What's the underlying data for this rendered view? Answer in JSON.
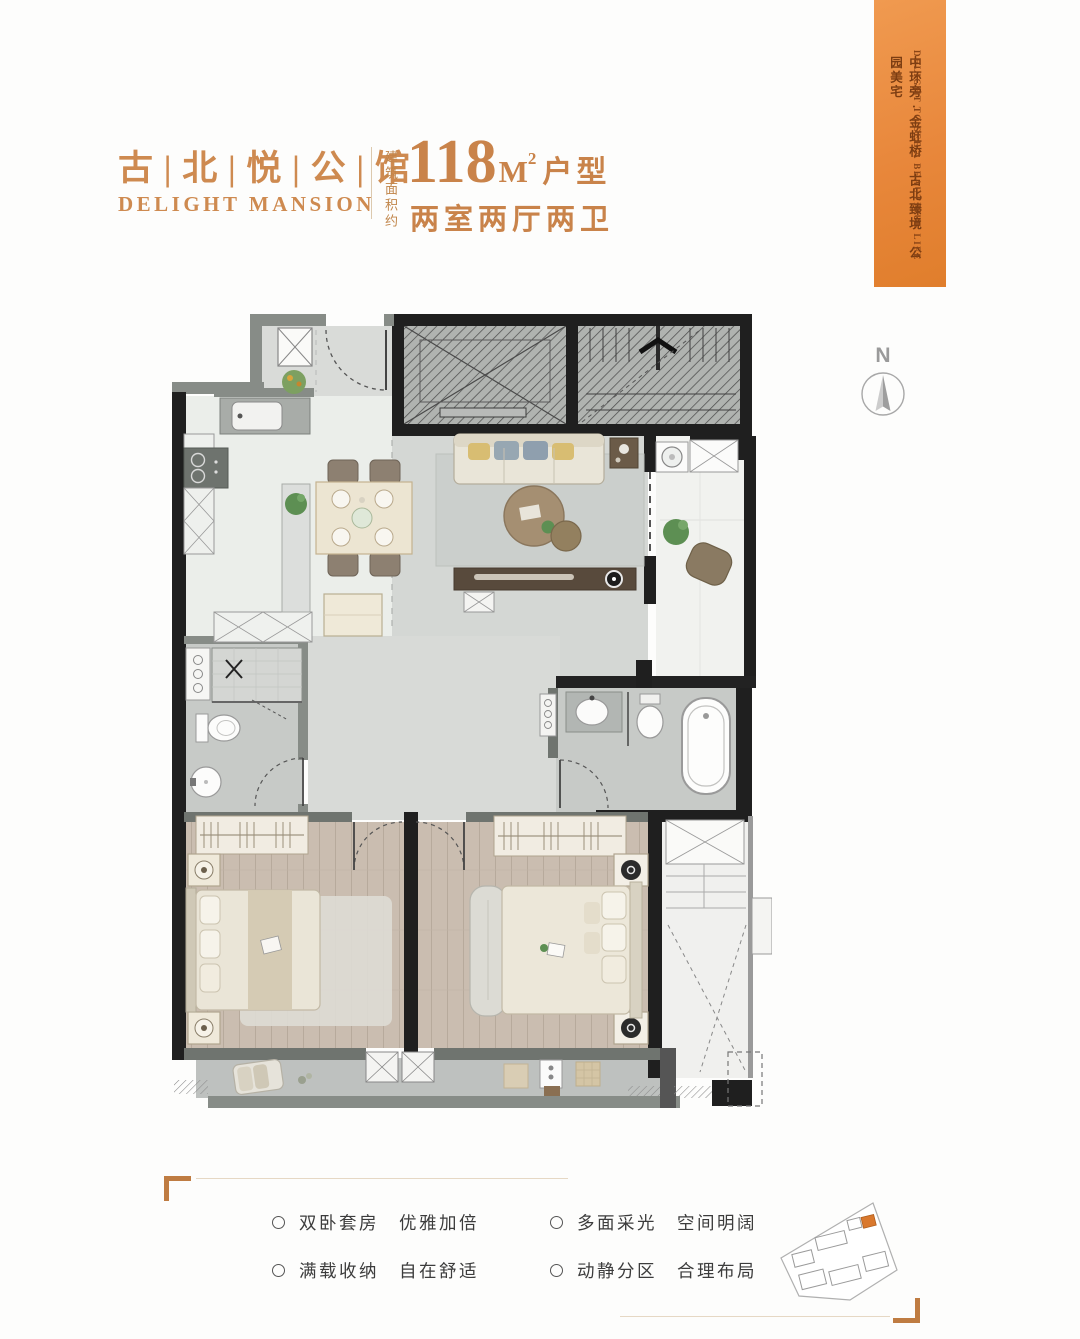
{
  "header": {
    "title_cn": "古 | 北 | 悦 | 公 | 馆",
    "title_en": "DELIGHT MANSION",
    "area_label_vertical": "建筑面积约",
    "area_number": "118",
    "area_unit": "M",
    "area_exponent": "2",
    "area_suffix": "户型",
    "layout_text": "两室两厅两卫"
  },
  "banner": {
    "cn_vertical": "中环旁·金虹桥　古北臻境　公园美宅",
    "en_vertical": "DELIGHT TO SEE A BEAUTIFUL LIFE",
    "bg_color": "#E8873B",
    "text_color": "#7C3D12"
  },
  "compass": {
    "label": "N"
  },
  "features": {
    "col1": [
      "双卧套房　优雅加倍",
      "满载收纳　自在舒适"
    ],
    "col2": [
      "多面采光　空间明阔",
      "动静分区　合理布局"
    ]
  },
  "colors": {
    "accent_orange": "#CE8A50",
    "banner_orange": "#E8873B",
    "bracket_orange": "#BF7C42",
    "site_plan_highlight": "#D9782D",
    "wall_black": "#1F1F1F",
    "wall_gray": "#878C87"
  }
}
